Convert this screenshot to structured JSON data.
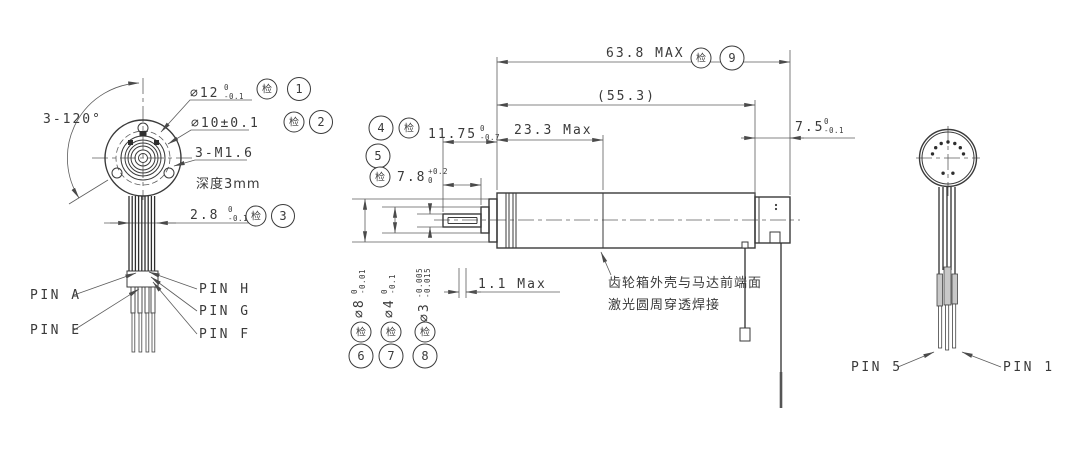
{
  "colors": {
    "line": "#3a3a3a",
    "dim_line": "#5c5c5c",
    "background": "#ffffff"
  },
  "front_view": {
    "angle_label": "3-120°",
    "dia12": {
      "value": "∅12",
      "tol_up": "0",
      "tol_dn": "-0.1",
      "inspect": "检",
      "balloon": "1"
    },
    "dia10": {
      "value": "∅10±0.1",
      "inspect": "检",
      "balloon": "2"
    },
    "thread_label": "3-M1.6",
    "depth_label": "深度3mm",
    "bundle_width": {
      "value": "2.8",
      "tol_up": "0",
      "tol_dn": "-0.1",
      "inspect": "检",
      "balloon": "3"
    },
    "pins": {
      "a": "PIN A",
      "e": "PIN E",
      "h": "PIN H",
      "g": "PIN G",
      "f": "PIN F"
    }
  },
  "side_view": {
    "total_length": {
      "value": "63.8 MAX",
      "inspect": "检",
      "balloon": "9"
    },
    "ref_length": "(55.3)",
    "gearbox_length": "23.3 Max",
    "shaft_length": {
      "value": "11.75",
      "tol_up": "0",
      "tol_dn": "-0.7",
      "inspect": "检",
      "balloon": "4"
    },
    "flat_length": {
      "value": "7.8",
      "tol_up": "+0.2",
      "tol_dn": "0",
      "inspect": "检",
      "balloon": "5"
    },
    "tail_length": {
      "value": "7.5",
      "tol_up": "0",
      "tol_dn": "-0.1"
    },
    "gap_length": "1.1 Max",
    "weld_note_line1": "齿轮箱外壳与马达前端面",
    "weld_note_line2": "激光圆周穿透焊接",
    "dia8": {
      "value": "∅8",
      "tol_up": "0",
      "tol_dn": "-0.01",
      "inspect": "检",
      "balloon": "6"
    },
    "dia4": {
      "value": "∅4",
      "tol_up": "0",
      "tol_dn": "-0.1",
      "inspect": "检",
      "balloon": "7"
    },
    "dia3": {
      "value": "∅3",
      "tol_up": "-0.005",
      "tol_dn": "-0.015",
      "inspect": "检",
      "balloon": "8"
    }
  },
  "rear_view": {
    "pin5": "PIN 5",
    "pin1": "PIN 1"
  }
}
